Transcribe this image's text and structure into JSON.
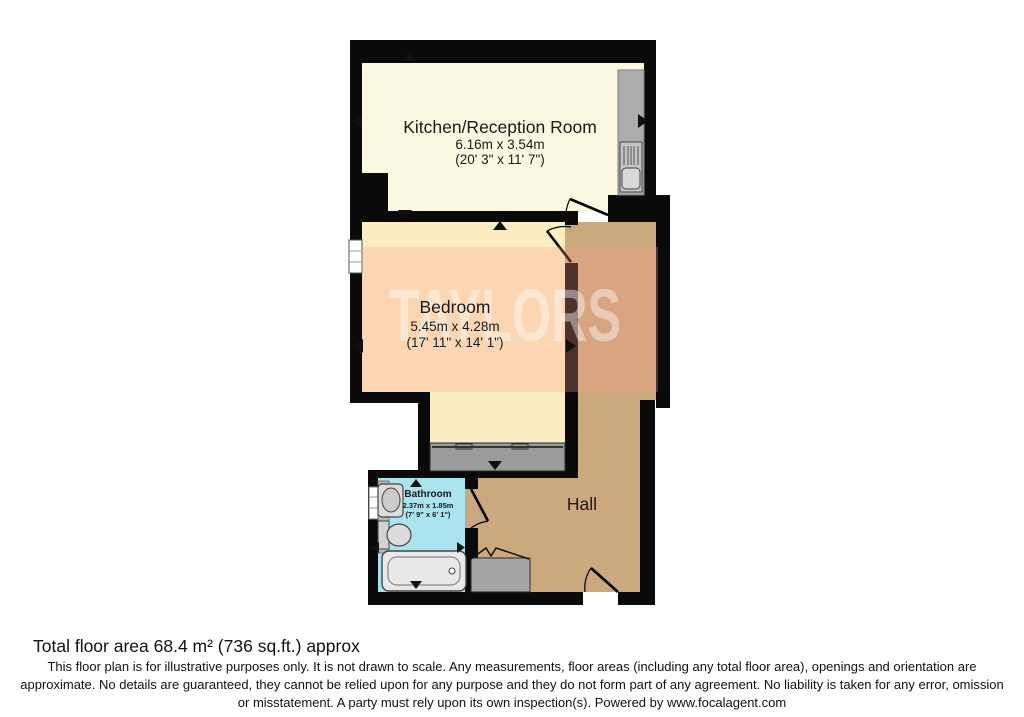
{
  "plan": {
    "rooms": {
      "kitchen": {
        "name": "Kitchen/Reception Room",
        "dims_metric": "6.16m x 3.54m",
        "dims_imperial": "(20' 3\" x 11' 7\")"
      },
      "bedroom": {
        "name": "Bedroom",
        "dims_metric": "5.45m x 4.28m",
        "dims_imperial": "(17' 11\" x 14' 1\")"
      },
      "bathroom": {
        "name": "Bathroom",
        "dims_metric": "2.37m x 1.85m",
        "dims_imperial": "(7' 9\" x 6' 1\")"
      },
      "hall": {
        "name": "Hall"
      }
    },
    "watermark": {
      "text": "TAYLORS"
    }
  },
  "footer": {
    "total_area": "Total floor area 68.4 m² (736 sq.ft.) approx",
    "disclaimer": "This floor plan is for illustrative purposes only. It is not drawn to scale. Any measurements, floor areas (including any total floor area), openings and orientation are approximate. No details are guaranteed, they cannot be relied upon for any purpose and they do not form part of any agreement. No liability is taken for any error, omission or misstatement. A party must rely upon its own inspection(s). Powered by www.focalagent.com"
  },
  "colors": {
    "wall": "#0A0A0A",
    "kitchen_floor": "#FBF8E1",
    "bedroom_floor": "#FBEDC1",
    "hall_floor": "#CBA87E",
    "bathroom_floor": "#A9E4EF",
    "counter_gray": "#ACACAC",
    "wardrobe_gray": "#9B9B9B",
    "closet_gray": "#A5A5A5",
    "watermark_tint": "#FF9A8C",
    "watermark_text_color": "#FFFFFF",
    "label_text": "#1A1A1A"
  }
}
